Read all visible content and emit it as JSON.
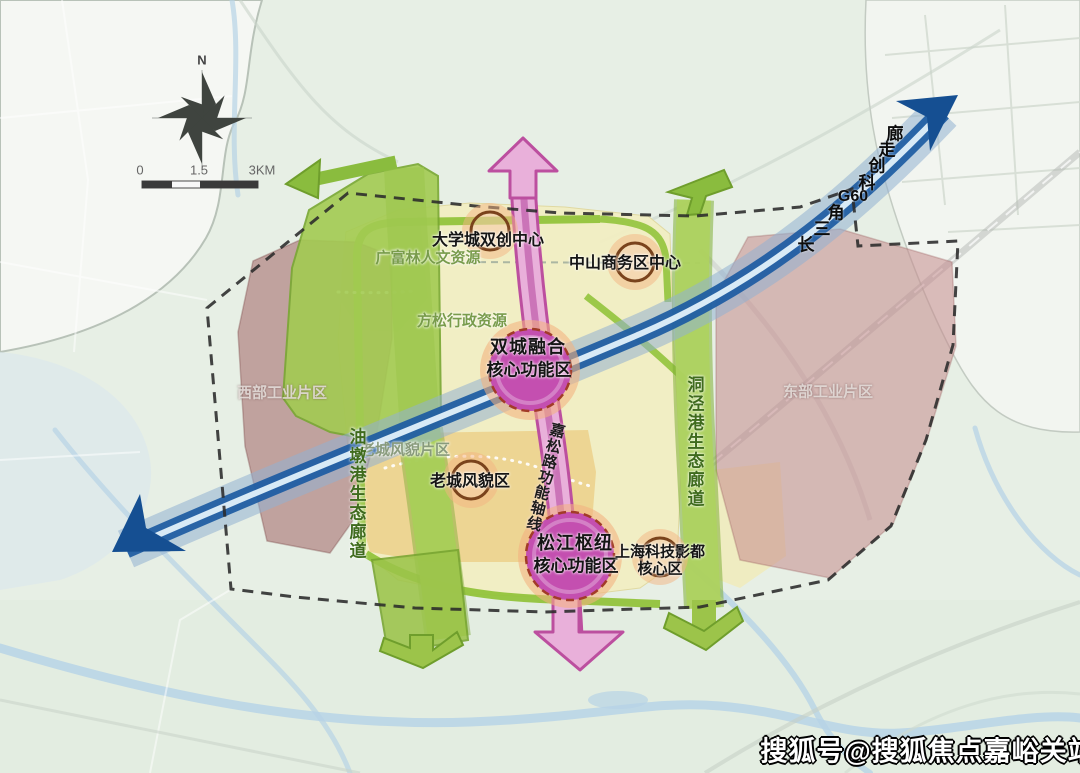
{
  "map": {
    "compass": {
      "north_label": "N"
    },
    "scale_bar": {
      "start": "0",
      "middle": "1.5",
      "end": "3KM"
    },
    "g60_corridor": {
      "full_label": "长三角G60科创走廊",
      "chars": [
        "长",
        "三",
        "角",
        "G60",
        "科",
        "创",
        "走",
        "廊"
      ]
    },
    "axis": {
      "label": "嘉松路功能轴线"
    },
    "eco_corridors": {
      "west": "油墩港生态廊道",
      "east": "洞泾港生态廊道"
    },
    "function_nodes": {
      "daxuecheng": "大学城双创中心",
      "zhongshan": "中山商务区中心",
      "shuangcheng_line1": "双城融合",
      "shuangcheng_line2": "核心功能区",
      "laocheng": "老城风貌区",
      "songjiang_line1": "松江枢纽",
      "songjiang_line2": "核心功能区",
      "yingdu_line1": "上海科技影都",
      "yingdu_line2": "核心区"
    },
    "area_labels": {
      "guangfulin": "广富林人文资源",
      "fangsong": "方松行政资源",
      "laocheng_district": "老城风貌片区",
      "west_industrial": "西部工业片区",
      "east_industrial": "东部工业片区"
    },
    "watermark": "搜狐号@搜狐焦点嘉峪关站",
    "colors": {
      "g60_band_dark": "#1c5ba2",
      "g60_arrow": "#154f92",
      "axis_pink": "#e9b0da",
      "axis_border": "#bc4f9f",
      "core_circle_magenta": "#c44fb0",
      "node_ring_brown": "#7a431c",
      "eco_green": "#a3cb52",
      "ring_road_green": "#92c33c",
      "core_yellow": "#f2eec3",
      "old_town_orange": "#edd28e",
      "industrial_mauve": "#a36b6b"
    }
  }
}
